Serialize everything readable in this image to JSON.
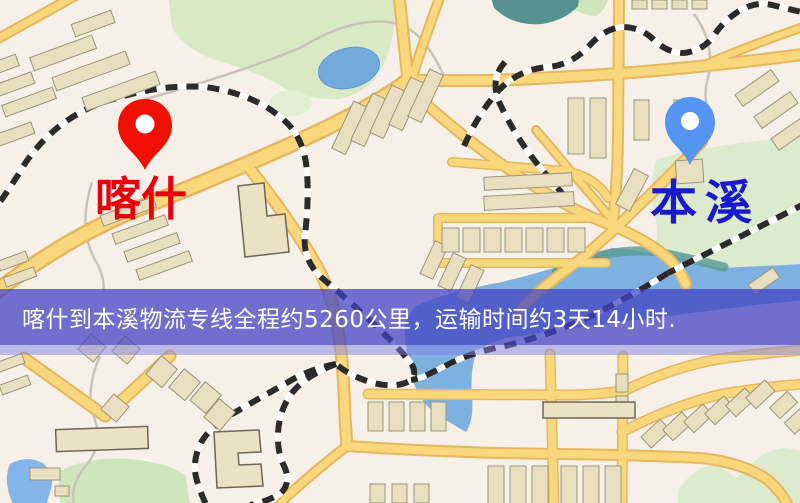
{
  "window": {
    "width": 800,
    "height": 503
  },
  "banner": {
    "text": "喀什到本溪物流专线全程约5260公里，运输时间约3天14小时.",
    "background_color": "#4242c4",
    "text_color": "#ffffff"
  },
  "map": {
    "background_color": "#f6f0e9",
    "road_color": "#f9d87d",
    "road_casing_color": "#e7b75f",
    "park_color": "#d9e9c6",
    "water_color": "#7fb1e0",
    "pond_color": "#74a9dc",
    "building_color": "#e9dfc0",
    "railway_color": "#2b2b2b",
    "origin": {
      "name": "喀什",
      "pin": "red-location-pin",
      "pin_color": "#f01005",
      "label_color": "#e8000a"
    },
    "destination": {
      "name": "本溪",
      "pin": "blue-location-pin",
      "pin_color": "#5694f2",
      "label_color": "#1919cd"
    }
  }
}
